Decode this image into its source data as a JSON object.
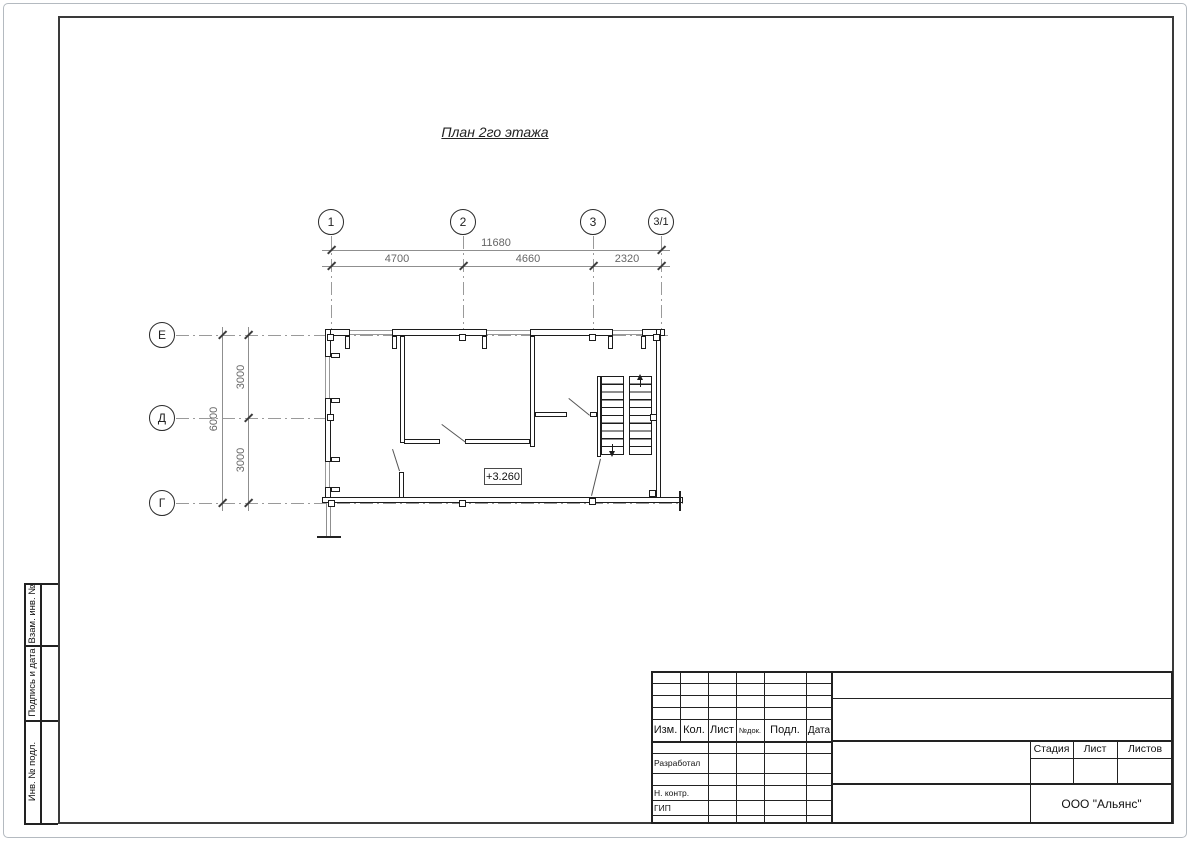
{
  "page": {
    "title": "План 2го этажа"
  },
  "plan": {
    "axes_top": [
      "1",
      "2",
      "3",
      "3/1"
    ],
    "axes_left": [
      "Е",
      "Д",
      "Г"
    ],
    "dim_total_top": "11680",
    "dim_top": [
      "4700",
      "4660",
      "2320"
    ],
    "dim_total_left": "6000",
    "dim_left": [
      "3000",
      "3000"
    ],
    "elevation": "+3.260"
  },
  "stamp": {
    "cols": [
      "Изм.",
      "Кол.",
      "Лист",
      "№док.",
      "Подл.",
      "Дата"
    ],
    "rows": [
      "Разработал",
      "Н. контр.",
      "ГИП"
    ],
    "stage": "Стадия",
    "sheet": "Лист",
    "sheets": "Листов",
    "company": "ООО \"Альянс\""
  },
  "margin": [
    "Взам. инв. №",
    "Подпись и дата",
    "Инв. № подл."
  ],
  "colors": {
    "line_dark": "#1c1c1c",
    "line_gray": "#9a9a9a",
    "dim_text": "#666666",
    "frame": "#3a3a3a"
  }
}
